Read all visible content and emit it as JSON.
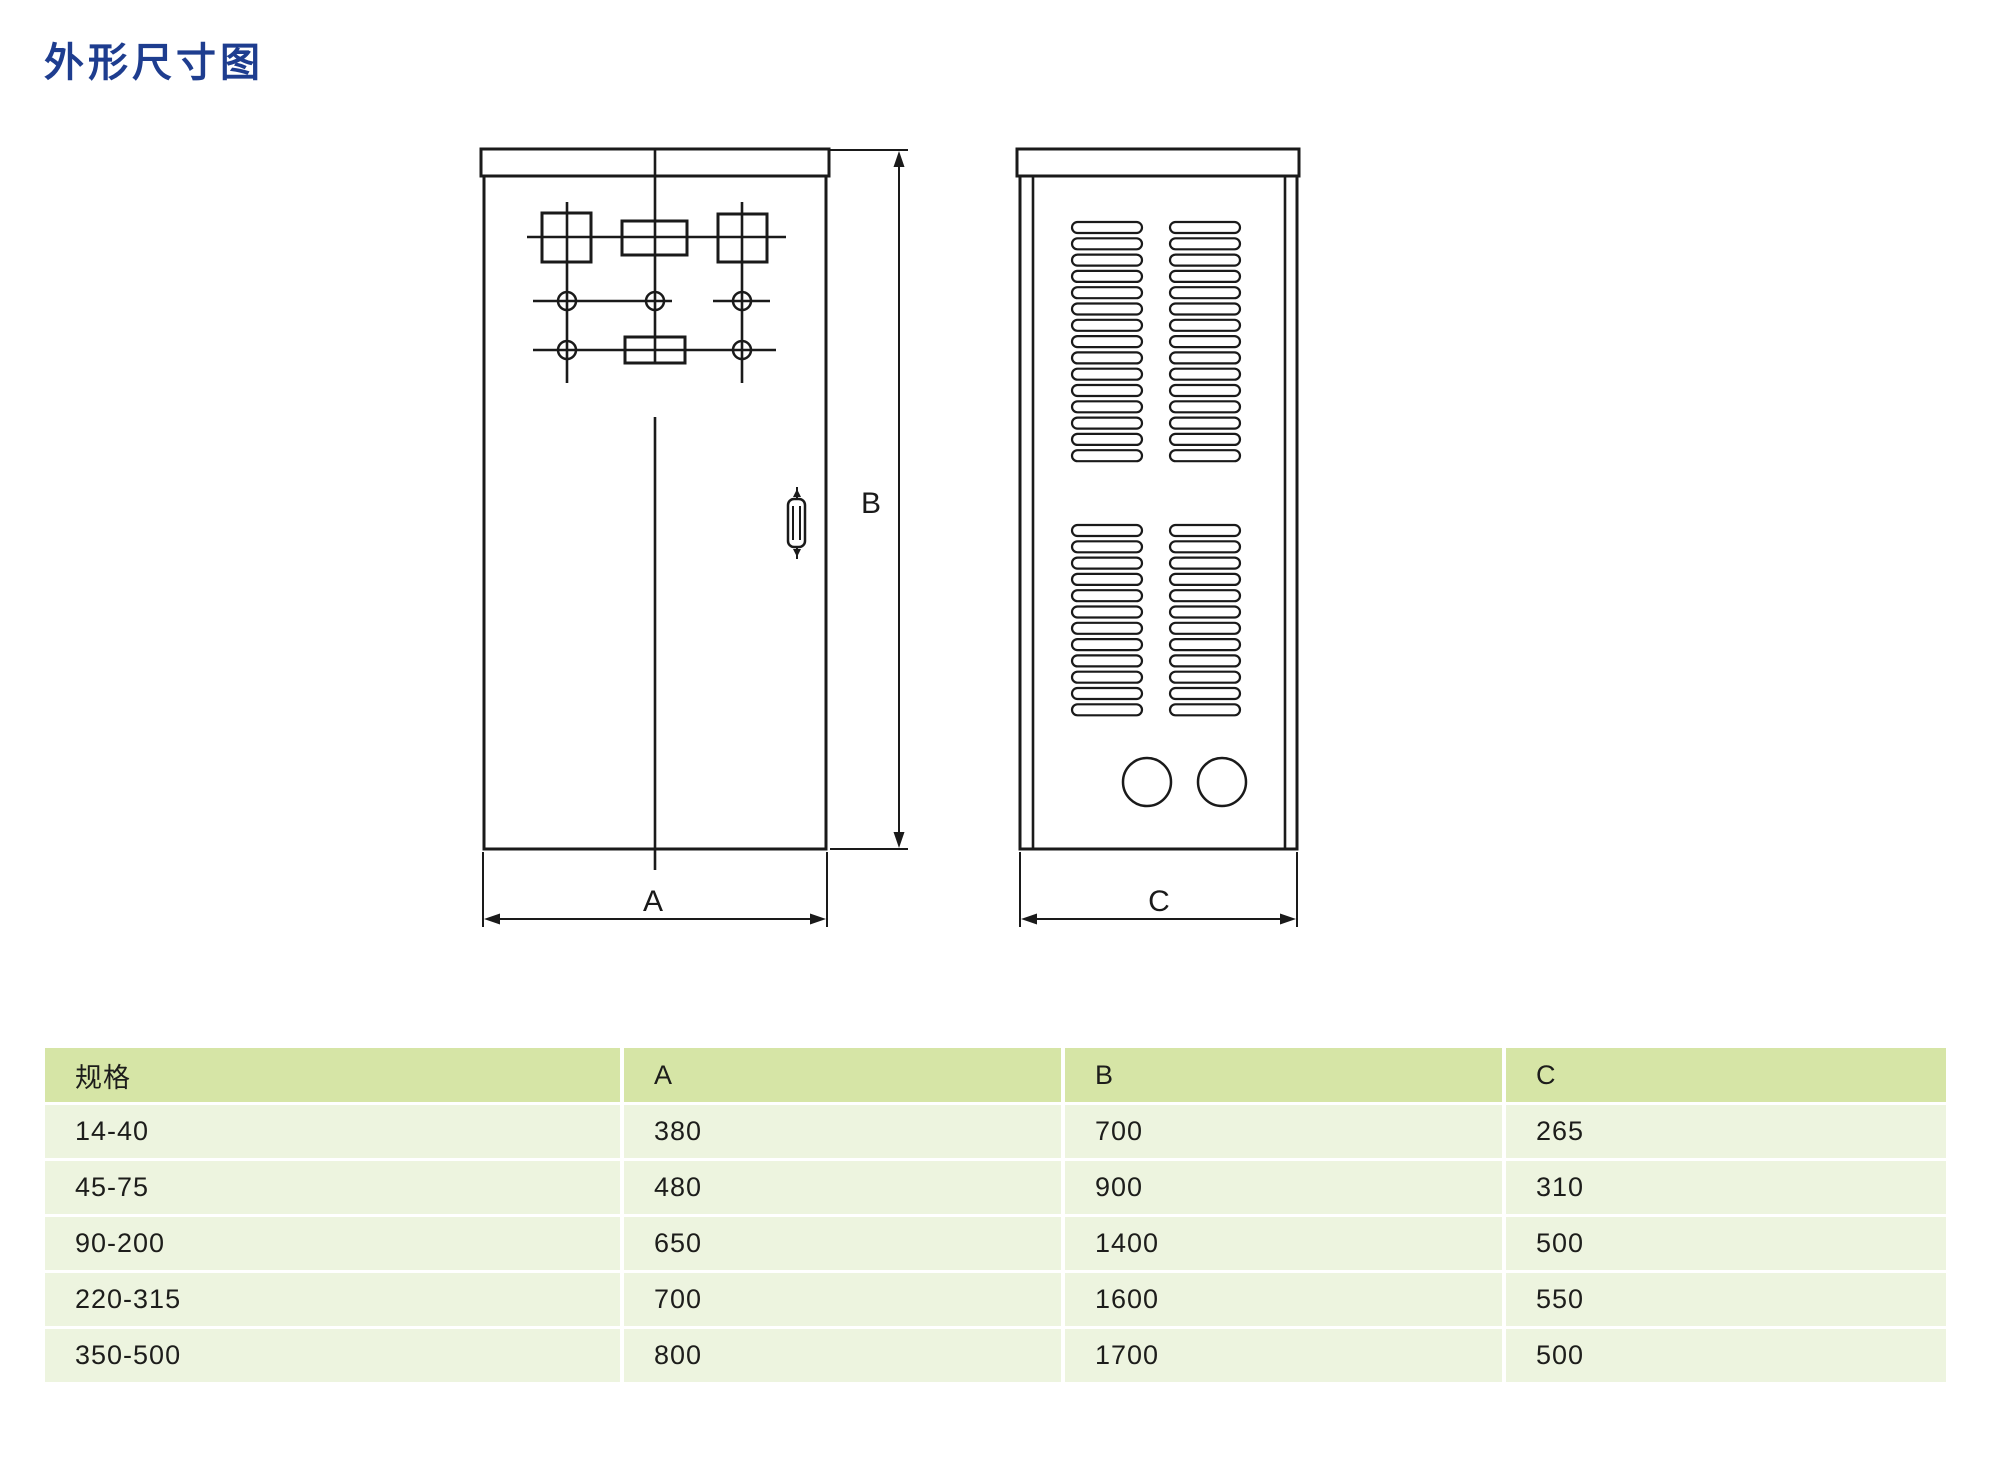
{
  "title": {
    "text": "外形尺寸图",
    "color": "#1e3d8f"
  },
  "diagram": {
    "labels": {
      "width": "A",
      "height": "B",
      "depth": "C"
    }
  },
  "table": {
    "header": [
      "规格",
      "A",
      "B",
      "C"
    ],
    "rows": [
      [
        "14-40",
        "380",
        "700",
        "265"
      ],
      [
        "45-75",
        "480",
        "900",
        "310"
      ],
      [
        "90-200",
        "650",
        "1400",
        "500"
      ],
      [
        "220-315",
        "700",
        "1600",
        "550"
      ],
      [
        "350-500",
        "800",
        "1700",
        "500"
      ]
    ],
    "colors": {
      "header_bg": "#d6e5a6",
      "row_bg": "#edf4df",
      "text": "#1d1d1b"
    }
  }
}
